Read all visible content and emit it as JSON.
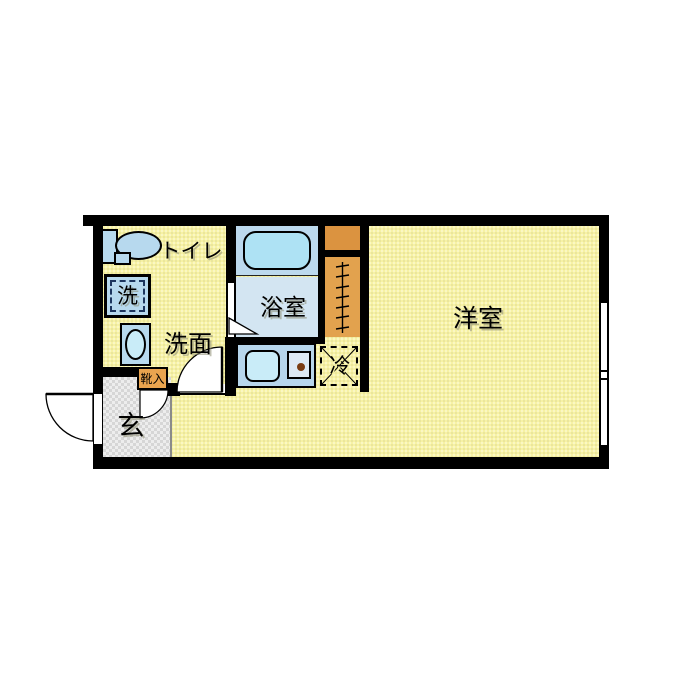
{
  "floorplan": {
    "rooms": {
      "western_room": {
        "label": "洋室"
      },
      "bathroom": {
        "label": "浴室"
      },
      "toilet": {
        "label": "トイレ"
      },
      "washroom": {
        "label": "洗面"
      },
      "entrance": {
        "label": "玄"
      },
      "shoe_storage": {
        "label": "靴入"
      },
      "refrigerator_space": {
        "label": "冷"
      },
      "washing_machine": {
        "label": "洗"
      }
    },
    "colors": {
      "wall": "#000000",
      "floor_yellow": "#f7f2a4",
      "entrance_floor_gray": "#dfdfdf",
      "fixture_blue": "#b7d9ee",
      "bathtub_cyan": "#aee2f4",
      "bath_floor_blue": "#d3e5f2",
      "bath_deck_blue": "#bcd9ee",
      "sink_cyan": "#c9ecf8",
      "counter_blue": "#b7d6ec",
      "storage_orange": "#e2a24e",
      "shoe_box_orange": "#e9a44f",
      "duct_box_orange": "#db9340",
      "burner_dot_brown": "#7a3c12"
    }
  }
}
